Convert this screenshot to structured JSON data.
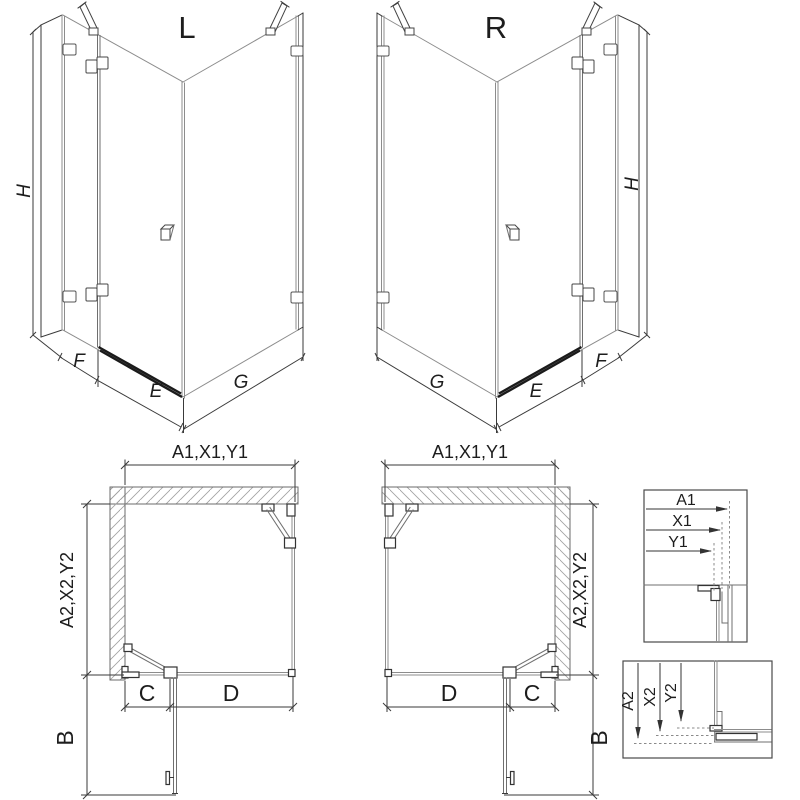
{
  "views": {
    "iso_left": {
      "label": "L",
      "height": "H",
      "fixed_width": "F",
      "door_width": "E",
      "side_width": "G"
    },
    "iso_right": {
      "label": "R",
      "height": "H",
      "fixed_width": "F",
      "door_width": "E",
      "side_width": "G"
    },
    "plan_left": {
      "width_dims": "A1,X1,Y1",
      "depth_dims": "A2,X2,Y2",
      "fixed_segment": "C",
      "door_segment": "D",
      "door_open_depth": "B"
    },
    "plan_right": {
      "width_dims": "A1,X1,Y1",
      "depth_dims": "A2,X2,Y2",
      "fixed_segment": "C",
      "door_segment": "D",
      "door_open_depth": "B"
    },
    "detail_width": {
      "dims": [
        "A1",
        "X1",
        "Y1"
      ]
    },
    "detail_depth": {
      "dims": [
        "A2",
        "X2",
        "Y2"
      ]
    }
  },
  "colors": {
    "background": "#ffffff",
    "line_primary": "#3a3a3a",
    "line_glass": "#8c8c8c",
    "hatch": "#a3a3a3",
    "threshold": "#1b1b1b",
    "text": "#1d1d1d"
  }
}
